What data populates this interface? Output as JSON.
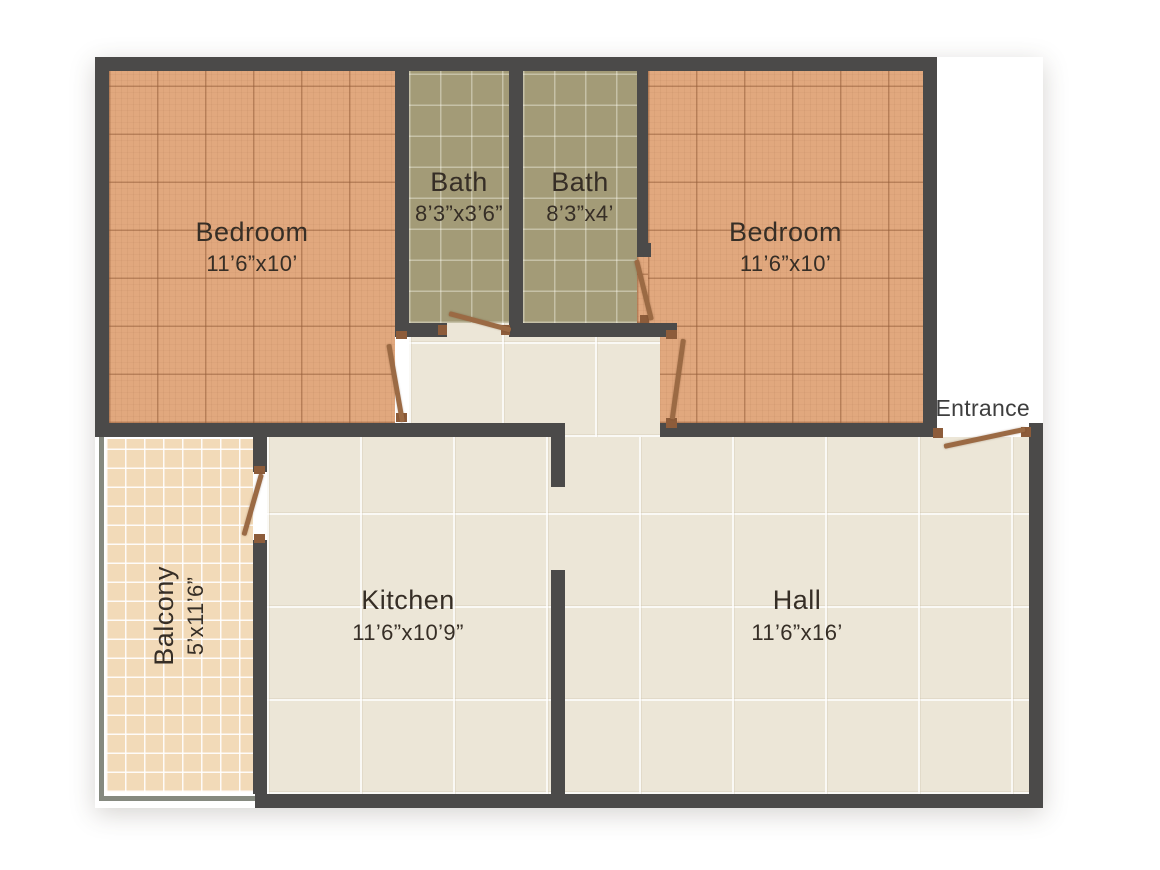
{
  "rooms": {
    "bedroom_left": {
      "name": "Bedroom",
      "dims": "11’6”x10’"
    },
    "bath_left": {
      "name": "Bath",
      "dims": "8’3”x3’6”"
    },
    "bath_right": {
      "name": "Bath",
      "dims": "8’3”x4’"
    },
    "bedroom_right": {
      "name": "Bedroom",
      "dims": "11’6”x10’"
    },
    "balcony": {
      "name": "Balcony",
      "dims": "5’x11’6”"
    },
    "kitchen": {
      "name": "Kitchen",
      "dims": "11’6”x10’9”"
    },
    "hall": {
      "name": "Hall",
      "dims": "11’6”x16’"
    }
  },
  "entrance": {
    "label": "Entrance"
  },
  "colors": {
    "wall": "#4b4a49",
    "bedroom_floor": "#e1a87e",
    "bath_floor": "#a39b77",
    "living_floor": "#ece6d7",
    "balcony_floor": "#f2dab8",
    "door": "#9b6a44",
    "door_frame": "#8d5c3a",
    "railing": "#85897f",
    "label_text": "#362e26"
  }
}
